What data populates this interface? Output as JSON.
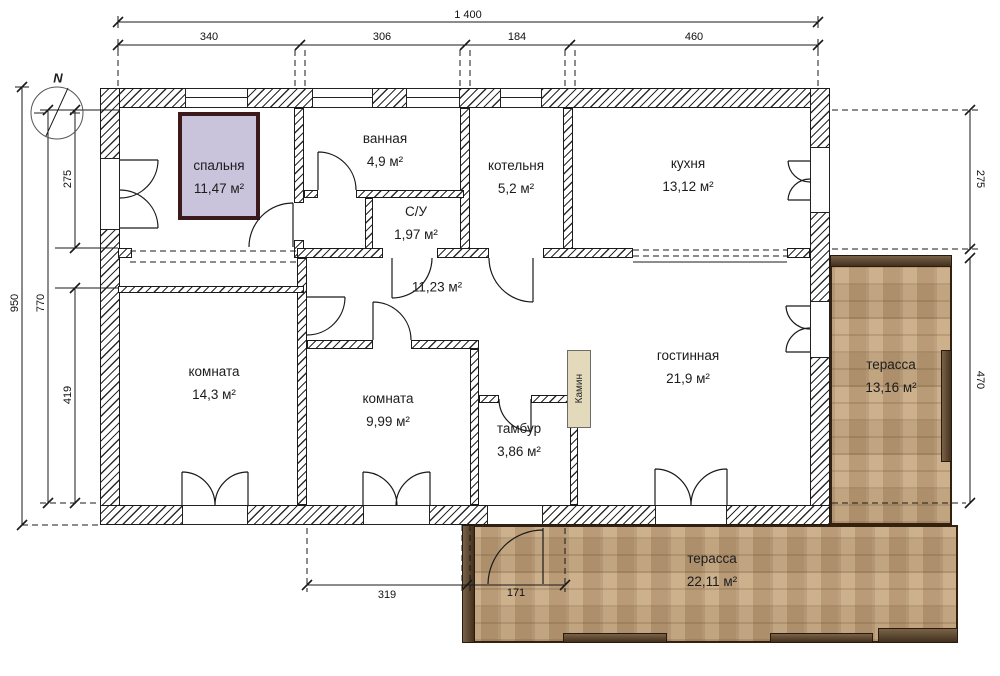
{
  "compass": {
    "north_label": "N"
  },
  "rooms": [
    {
      "name": "спальня",
      "area": "11,47 м²"
    },
    {
      "name": "ванная",
      "area": "4,9 м²"
    },
    {
      "name": "С/У",
      "area": "1,97 м²"
    },
    {
      "name": "котельня",
      "area": "5,2 м²"
    },
    {
      "name": "кухня",
      "area": "13,12 м²"
    },
    {
      "name": "",
      "area": "11,23 м²"
    },
    {
      "name": "комната",
      "area": "14,3 м²"
    },
    {
      "name": "комната",
      "area": "9,99 м²"
    },
    {
      "name": "тамбур",
      "area": "3,86 м²"
    },
    {
      "name": "гостинная",
      "area": "21,9 м²"
    },
    {
      "name": "терасса",
      "area": "13,16 м²"
    },
    {
      "name": "терасса",
      "area": "22,11 м²"
    }
  ],
  "fireplace": {
    "label": "Камин"
  },
  "dimensions": {
    "top_total": "1 400",
    "top_segments": [
      "340",
      "306",
      "184",
      "460"
    ],
    "left_total": "950",
    "left_inner": "770",
    "left_upper": "275",
    "left_lower": "419",
    "right_upper": "275",
    "right_terrace": "470",
    "bottom_room": "319",
    "bottom_door": "171"
  },
  "colors": {
    "selected_room_fill": "#c9c4dc",
    "selected_room_border": "#3c191b",
    "terrace_wood": "#c4a379",
    "terrace_border": "#33200f",
    "fireplace_fill": "#e3dabc",
    "wall_line": "#1a1a1a"
  }
}
